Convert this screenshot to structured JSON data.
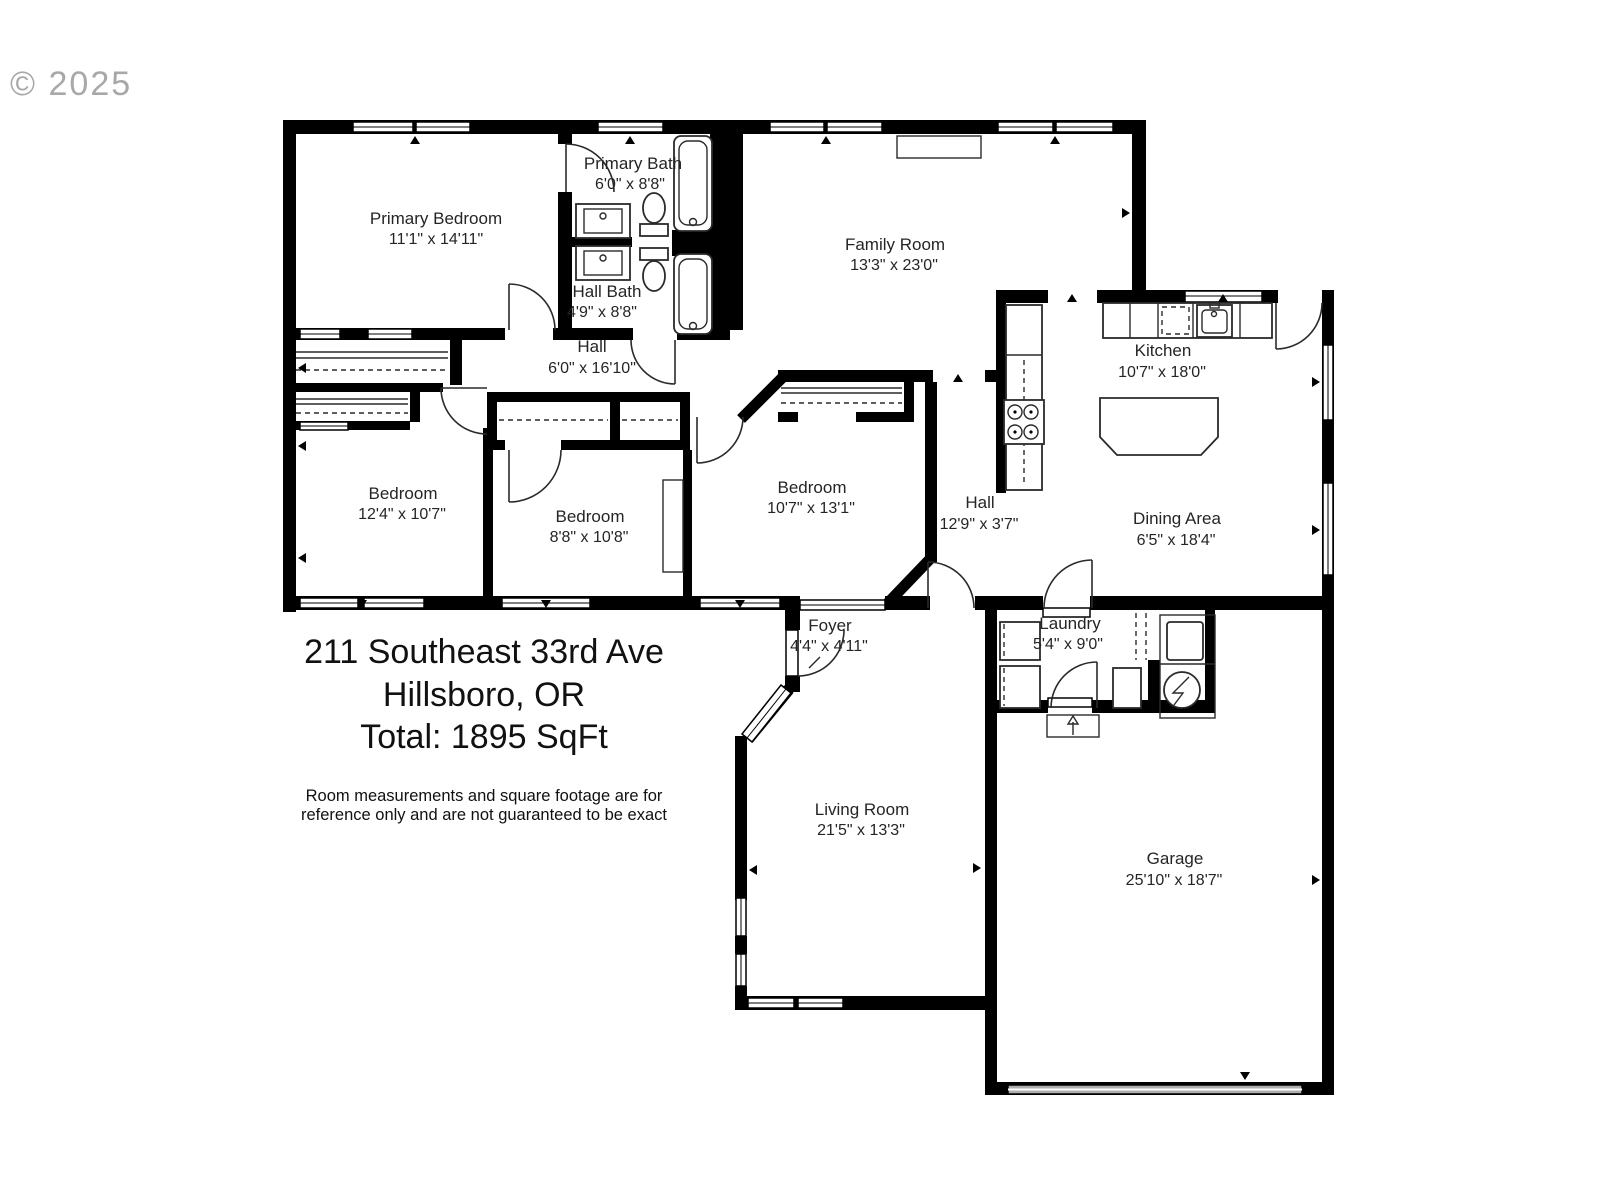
{
  "watermark": "© 2025",
  "address": {
    "line1": "211 Southeast 33rd Ave",
    "line2": "Hillsboro, OR",
    "total": "Total: 1895 SqFt"
  },
  "disclaimer": {
    "line1": "Room measurements and square footage are for",
    "line2": "reference only and are not guaranteed to be exact"
  },
  "rooms": {
    "primary_bedroom": {
      "name": "Primary Bedroom",
      "dims": "11'1\" x 14'11\""
    },
    "primary_bath": {
      "name": "Primary Bath",
      "dims": "6'0\" x 8'8\""
    },
    "hall_bath": {
      "name": "Hall Bath",
      "dims": "4'9\" x 8'8\""
    },
    "hall_upper": {
      "name": "Hall",
      "dims": "6'0\" x 16'10\""
    },
    "family_room": {
      "name": "Family Room",
      "dims": "13'3\" x 23'0\""
    },
    "kitchen": {
      "name": "Kitchen",
      "dims": "10'7\" x 18'0\""
    },
    "bedroom_left": {
      "name": "Bedroom",
      "dims": "12'4\" x 10'7\""
    },
    "bedroom_middle": {
      "name": "Bedroom",
      "dims": "8'8\" x 10'8\""
    },
    "bedroom_right": {
      "name": "Bedroom",
      "dims": "10'7\" x 13'1\""
    },
    "hall_lower": {
      "name": "Hall",
      "dims": "12'9\" x 3'7\""
    },
    "dining_area": {
      "name": "Dining Area",
      "dims": "6'5\" x 18'4\""
    },
    "foyer": {
      "name": "Foyer",
      "dims": "4'4\" x 4'11\""
    },
    "laundry": {
      "name": "Laundry",
      "dims": "5'4\" x 9'0\""
    },
    "living_room": {
      "name": "Living Room",
      "dims": "21'5\" x 13'3\""
    },
    "garage": {
      "name": "Garage",
      "dims": "25'10\" x 18'7\""
    }
  }
}
